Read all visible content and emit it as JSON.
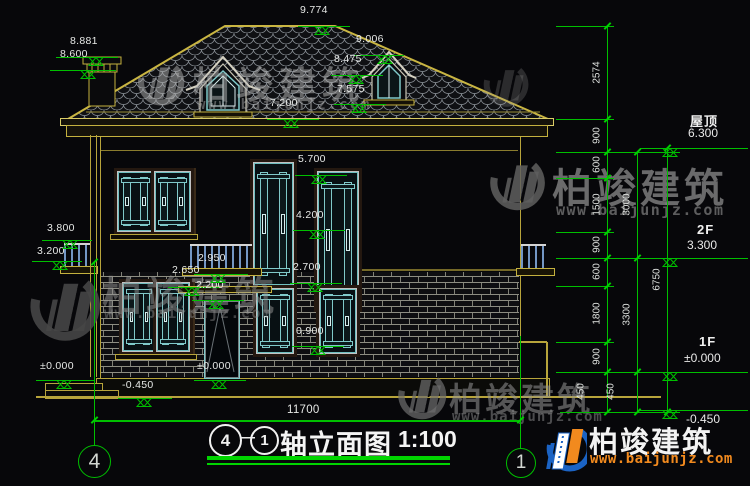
{
  "watermark": {
    "brand": "柏竣建筑",
    "url": "www.baijunjz.com"
  },
  "markers": {
    "e9774": "9.774",
    "e8881": "8.881",
    "e8600": "8.600",
    "e9006": "9.006",
    "e8475": "8.475",
    "e7575": "7.575",
    "e7200": "7.200",
    "e5700": "5.700",
    "e4200": "4.200",
    "e3800": "3.800",
    "e3200": "3.200",
    "e2950": "2.950",
    "e2650": "2.650",
    "e2200": "2.200",
    "e2700": "2.700",
    "e0900": "0.900",
    "e0000L": "±0.000",
    "e0000D": "±0.000",
    "e0450B": "-0.450"
  },
  "chains": {
    "chain_a": [
      "2574",
      "900",
      "600",
      "1500",
      "900",
      "600",
      "1800",
      "900",
      "450"
    ],
    "chain_b": [
      "3000",
      "3300",
      "450"
    ],
    "chain_c": [
      "6750"
    ]
  },
  "floors": [
    {
      "name": "屋顶",
      "elev": "6.300"
    },
    {
      "name": "2F",
      "elev": "3.300"
    },
    {
      "name": "1F",
      "elev": "±0.000"
    },
    {
      "name": "",
      "elev": "-0.450"
    }
  ],
  "bottom": {
    "width_dim": "11700",
    "axis_left": "4",
    "axis_right": "1"
  },
  "title": {
    "bubble_left": "4",
    "dash": "—",
    "bubble_right": "1",
    "text": "轴立面图",
    "scale": "1:100"
  },
  "colors": {
    "dim_green": "#00bf00",
    "cad_yellow": "#c4b13e",
    "window_teal": "#7fc9c9",
    "brand_orange": "#f28a1e",
    "brand_blue": "#1b63c4"
  }
}
